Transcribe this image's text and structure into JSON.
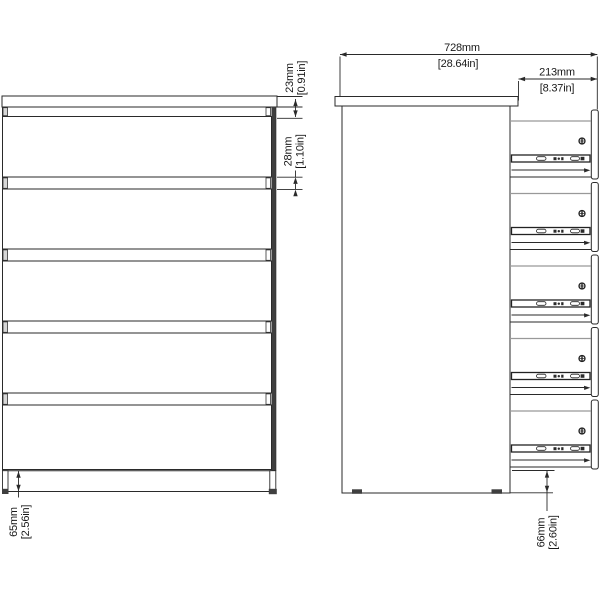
{
  "figure": {
    "kind": "furniture technical drawing",
    "views": [
      "front",
      "side-section"
    ],
    "drawer_count": 5
  },
  "dimensions": {
    "total_width": {
      "mm": "728mm",
      "inches": "[28.64in]"
    },
    "drawer_depth": {
      "mm": "213mm",
      "inches": "[8.37in]"
    },
    "top_reveal": {
      "mm": "23mm",
      "inches": "[0.91in]"
    },
    "drawer_gap": {
      "mm": "28mm",
      "inches": "[1.10in]"
    },
    "front_base_height": {
      "mm": "65mm",
      "inches": "[2.56in]"
    },
    "side_base_clearance": {
      "mm": "66mm",
      "inches": "[2.60in]"
    }
  },
  "colors": {
    "line": "#2a2a2a",
    "dark_edge": "#3f3f3f",
    "slide_gray": "#999999",
    "background": "#ffffff",
    "text": "#1a1a1a"
  }
}
